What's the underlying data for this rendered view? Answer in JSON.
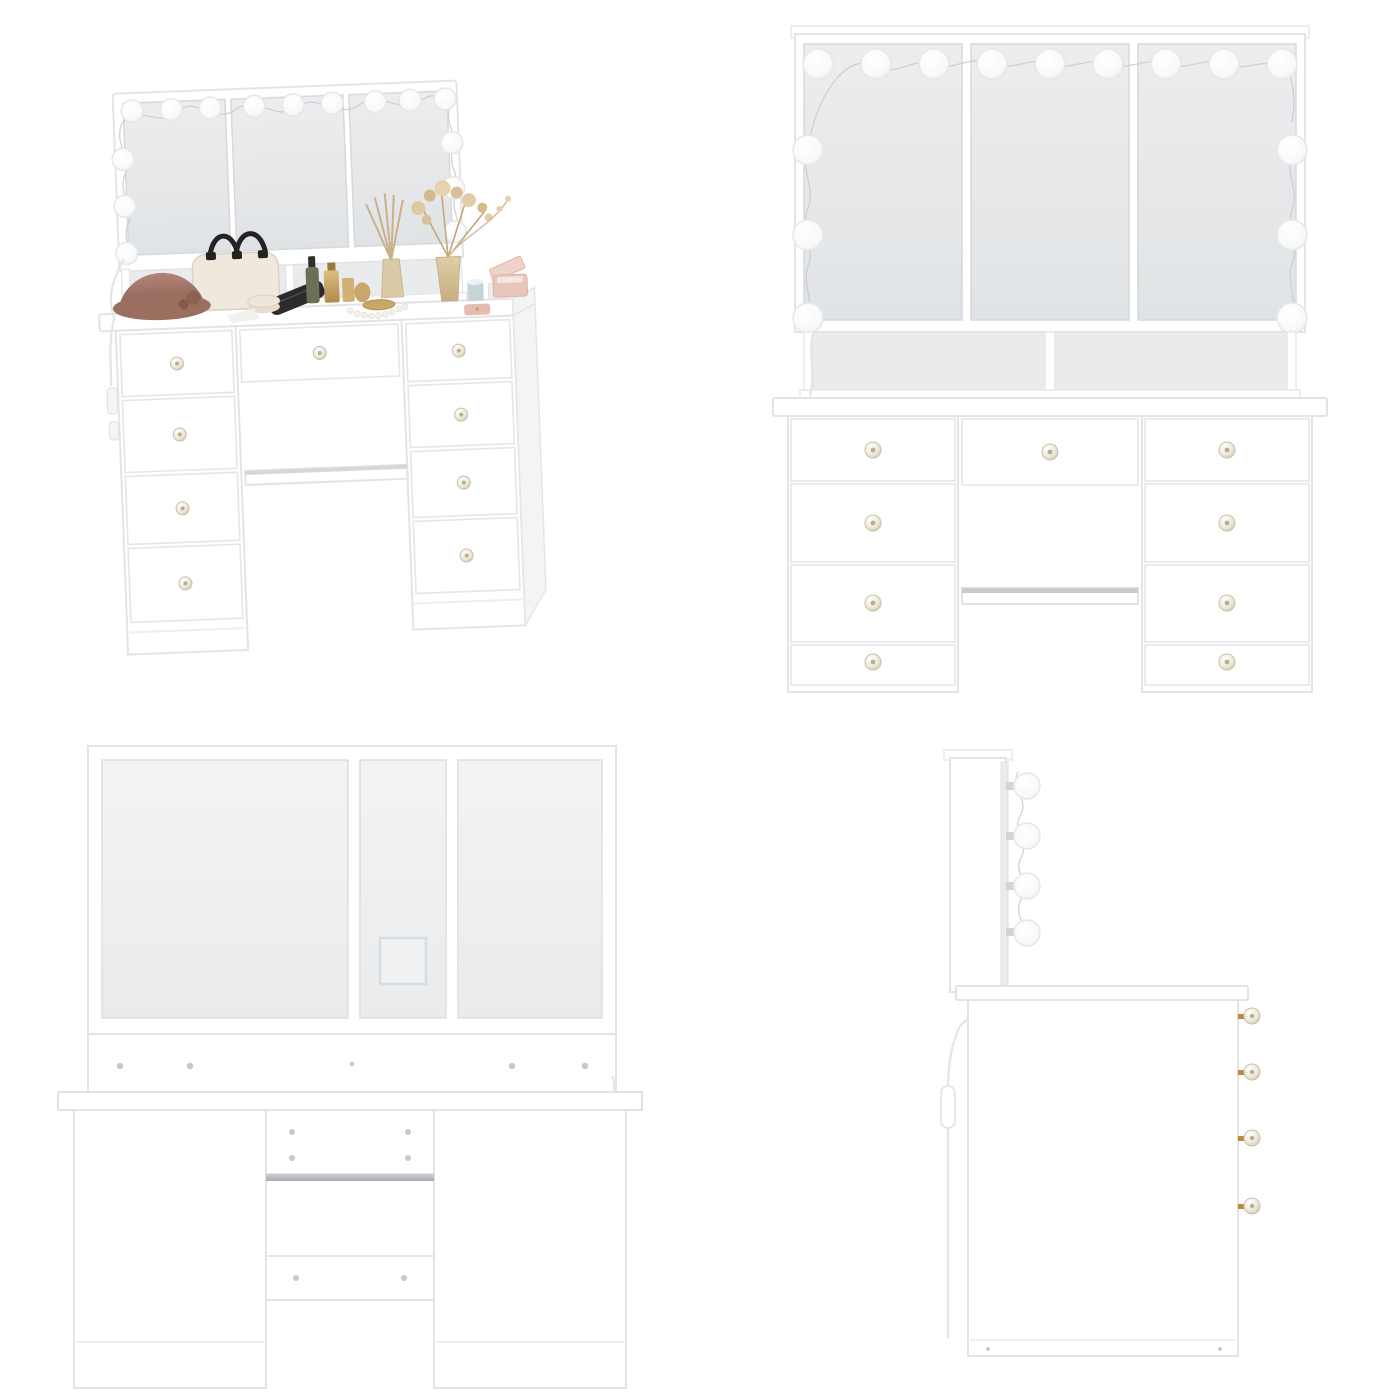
{
  "page": {
    "background": "#ffffff",
    "layout": "2x2-product-views"
  },
  "product": {
    "type": "vanity-dressing-table-with-hollywood-mirror",
    "finish_color": "#ffffff",
    "mirror_panels": 3,
    "drawer_count": 9,
    "front_bulb_count": 15,
    "side_bulb_count": 4
  },
  "views": [
    {
      "id": "angled",
      "alt": "Angled front view of white vanity table with tri-fold lighted mirror, open shelf, nine drawers and styled makeup props",
      "bulbs_top": 9,
      "bulbs_left": 3,
      "bulbs_right": 3,
      "drawers_left": 4,
      "drawers_center": 1,
      "drawers_right": 4,
      "has_knee_shelf": true,
      "props": [
        "cream-handbag",
        "brown-cloche-hat",
        "black-clutch",
        "powder-jar",
        "green-dropper-bottle",
        "gold-perfume-bottles",
        "gold-tray",
        "pearl-necklace",
        "reed-diffuser",
        "amber-vase-dried-flowers",
        "blue-candle",
        "cotton-swab-cup",
        "pink-jewelry-box",
        "pink-case"
      ]
    },
    {
      "id": "front",
      "alt": "Straight-on front view of white vanity with tri-fold mirror, fifteen string bulbs, divided open shelf, nine drawers and knee shelf",
      "bulbs_top": 9,
      "bulbs_left": 3,
      "bulbs_right": 3,
      "drawers_left": 4,
      "drawers_center": 1,
      "drawers_right": 4,
      "has_knee_shelf": true
    },
    {
      "id": "back",
      "alt": "Back view of vanity showing rear panels, square cable cutout, mounting rails, metal strip and assembly screws",
      "cable_cutout": true,
      "rail_screws": 5,
      "crossbar_screws": 4,
      "shelf_screws": 2
    },
    {
      "id": "side",
      "alt": "Side profile of vanity with four mirror bulbs on brackets, hanging power cord with inline switch and four protruding drawer knobs",
      "bulbs": 4,
      "knobs": 4,
      "has_cord_switch": true
    }
  ],
  "colors": {
    "furniture_white": "#ffffff",
    "mirror_glass": "#e8eaec",
    "panel_shadow": "#dfe2e4",
    "outline": "#d9dcdf",
    "bulb": "#fafbfc",
    "string_wire": "#c8cbce",
    "knob_crystal": "#e9e4d5",
    "knob_gold": "#b98a3c",
    "metal_strip": "#a6aaae",
    "hat_brown": "#a57a6b",
    "bag_cream": "#efe8dc",
    "handle_black": "#1f1f20",
    "gold": "#c9a66b",
    "amber": "#d8c49a",
    "sage_green": "#6a6f55",
    "candle_blue": "#c7d3d9",
    "blush_pink": "#e8c4ba",
    "dried_flower_tan": "#d9c09a",
    "cord_white": "#e6e8ea"
  }
}
